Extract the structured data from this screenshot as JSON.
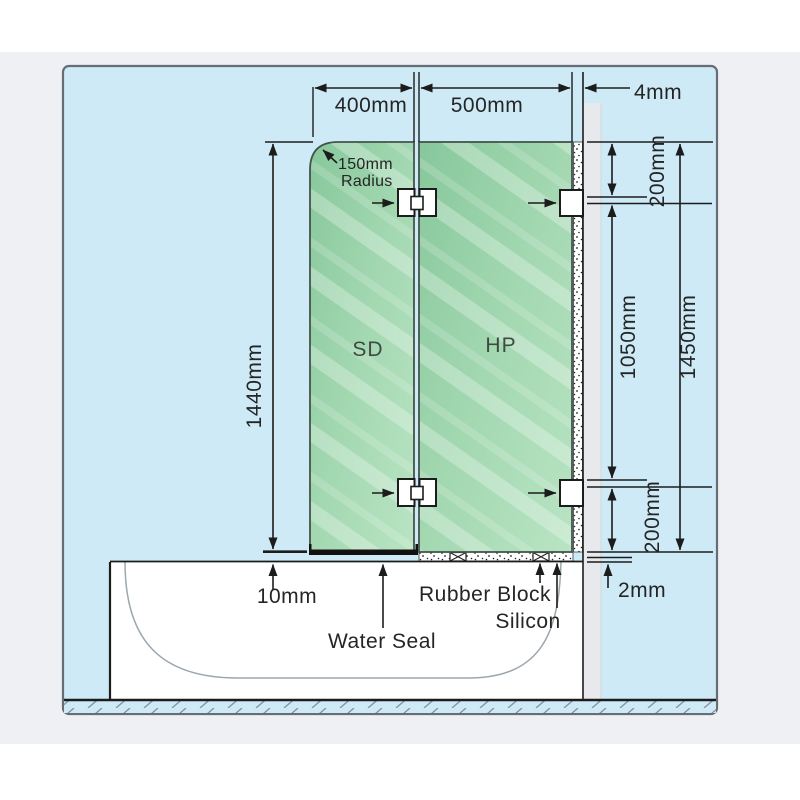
{
  "page": {
    "background": "#ffffff",
    "band_background": "#eef0f3"
  },
  "drawing": {
    "canvas_background": "#cdeaf6",
    "border_color": "#676d75",
    "line_color": "#1c1c1c",
    "wall_color": "#e8e9ec",
    "glass_edge_color": "#44544b",
    "glass_gradient_from": "#87c79b",
    "glass_gradient_to": "#b9e4c3",
    "panels": {
      "door_label": "SD",
      "fixed_label": "HP"
    },
    "dims": {
      "top_width_left": "400mm",
      "top_width_right": "500mm",
      "wall_gap": "4mm",
      "corner_radius_line1": "150mm",
      "corner_radius_line2": "Radius",
      "door_height": "1440mm",
      "hinge_top_offset": "200mm",
      "hinge_spacing": "1050mm",
      "fixed_panel_height": "1450mm",
      "hinge_bottom_offset": "200mm",
      "bottom_gap": "10mm",
      "silicon_bed": "2mm"
    },
    "callouts": {
      "water_seal": "Water Seal",
      "rubber_block": "Rubber Block",
      "silicon": "Silicon"
    }
  }
}
